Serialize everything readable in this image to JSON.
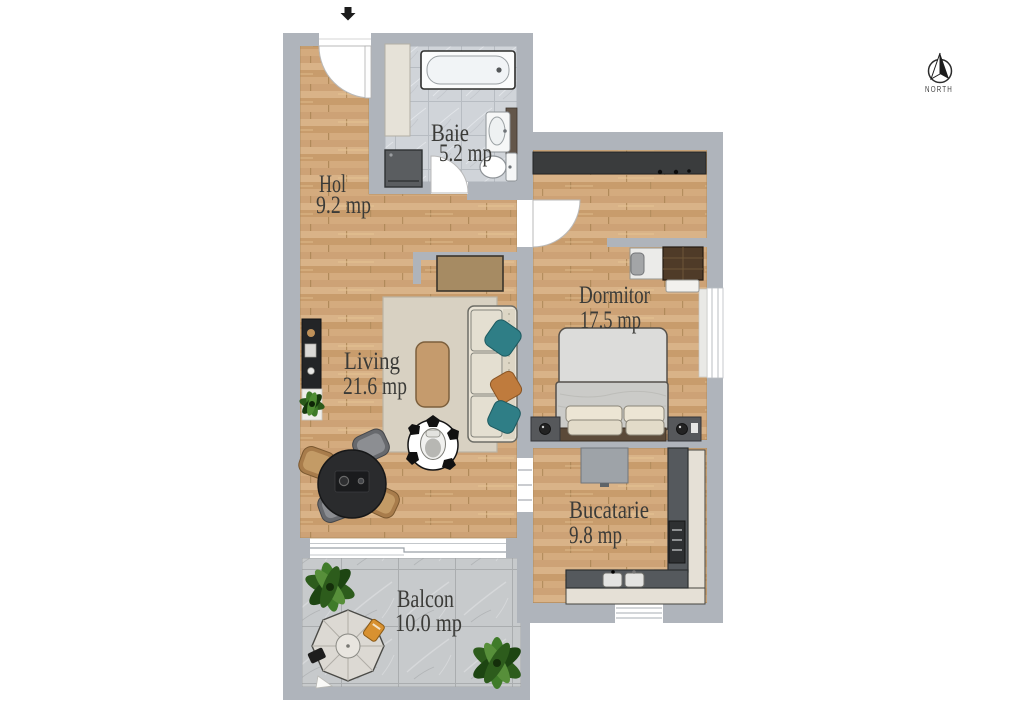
{
  "plan_title": "Apartment floor plan",
  "north": {
    "label": "NORTH"
  },
  "rooms": {
    "baie": {
      "name": "Baie",
      "area": "5.2 mp"
    },
    "hol": {
      "name": "Hol",
      "area": "9.2 mp"
    },
    "dormitor": {
      "name": "Dormitor",
      "area": "17.5 mp"
    },
    "living": {
      "name": "Living",
      "area": "21.6 mp"
    },
    "bucatarie": {
      "name": "Bucatarie",
      "area": "9.8 mp"
    },
    "balcon": {
      "name": "Balcon",
      "area": "10.0 mp"
    }
  },
  "icons": {
    "north_compass": "north-compass-icon",
    "entry_arrow": "entry-arrow-icon"
  },
  "colors": {
    "wall": "#afb4bb",
    "wood_floor": "#d2aa7d",
    "bath_tile": "#d0d4d9",
    "balcony_tile": "#c7cacc",
    "label_text": "#3b3b38",
    "accent_teal": "#2f7e86",
    "accent_orange": "#bf7b3d",
    "plant_green": "#3f7b29"
  }
}
